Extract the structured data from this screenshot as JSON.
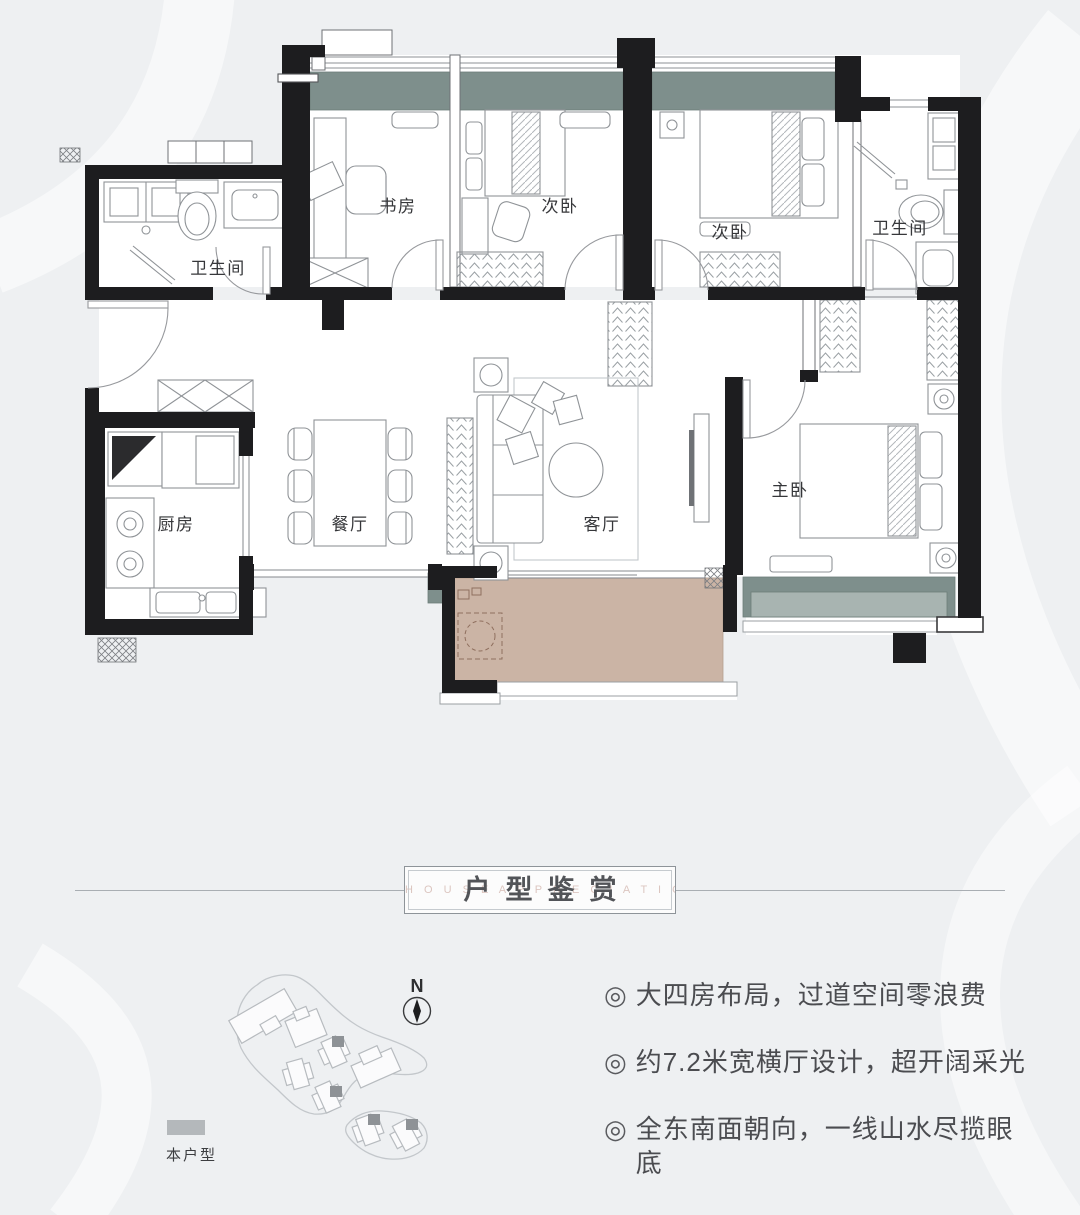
{
  "floorplan": {
    "rooms": [
      {
        "name": "bathroom-1",
        "label": "卫生间"
      },
      {
        "name": "study",
        "label": "书房"
      },
      {
        "name": "bedroom-2",
        "label": "次卧"
      },
      {
        "name": "bedroom-3",
        "label": "次卧"
      },
      {
        "name": "bathroom-2",
        "label": "卫生间"
      },
      {
        "name": "kitchen",
        "label": "厨房"
      },
      {
        "name": "dining-room",
        "label": "餐厅"
      },
      {
        "name": "living-room",
        "label": "客厅"
      },
      {
        "name": "master-bedroom",
        "label": "主卧"
      }
    ],
    "colors": {
      "wall": "#1d1d1f",
      "window_band": "#7e8f8c",
      "window_band_inner": "#a8b4b1",
      "balcony_floor": "#cbb4a5",
      "furniture_line": "#8f9397"
    }
  },
  "title_section": {
    "title": "户型鉴赏",
    "watermark": "H O U S E   A P P R E C I A T I O N"
  },
  "features": [
    {
      "marker": "◎",
      "text": "大四房布局，过道空间零浪费"
    },
    {
      "marker": "◎",
      "text": "约7.2米宽横厅设计，超开阔采光"
    },
    {
      "marker": "◎",
      "text": "全东南面朝向，一线山水尽揽眼底"
    }
  ],
  "site_plan": {
    "compass_label": "N",
    "legend_label": "本户型",
    "legend_color": "#b4b8bb"
  }
}
